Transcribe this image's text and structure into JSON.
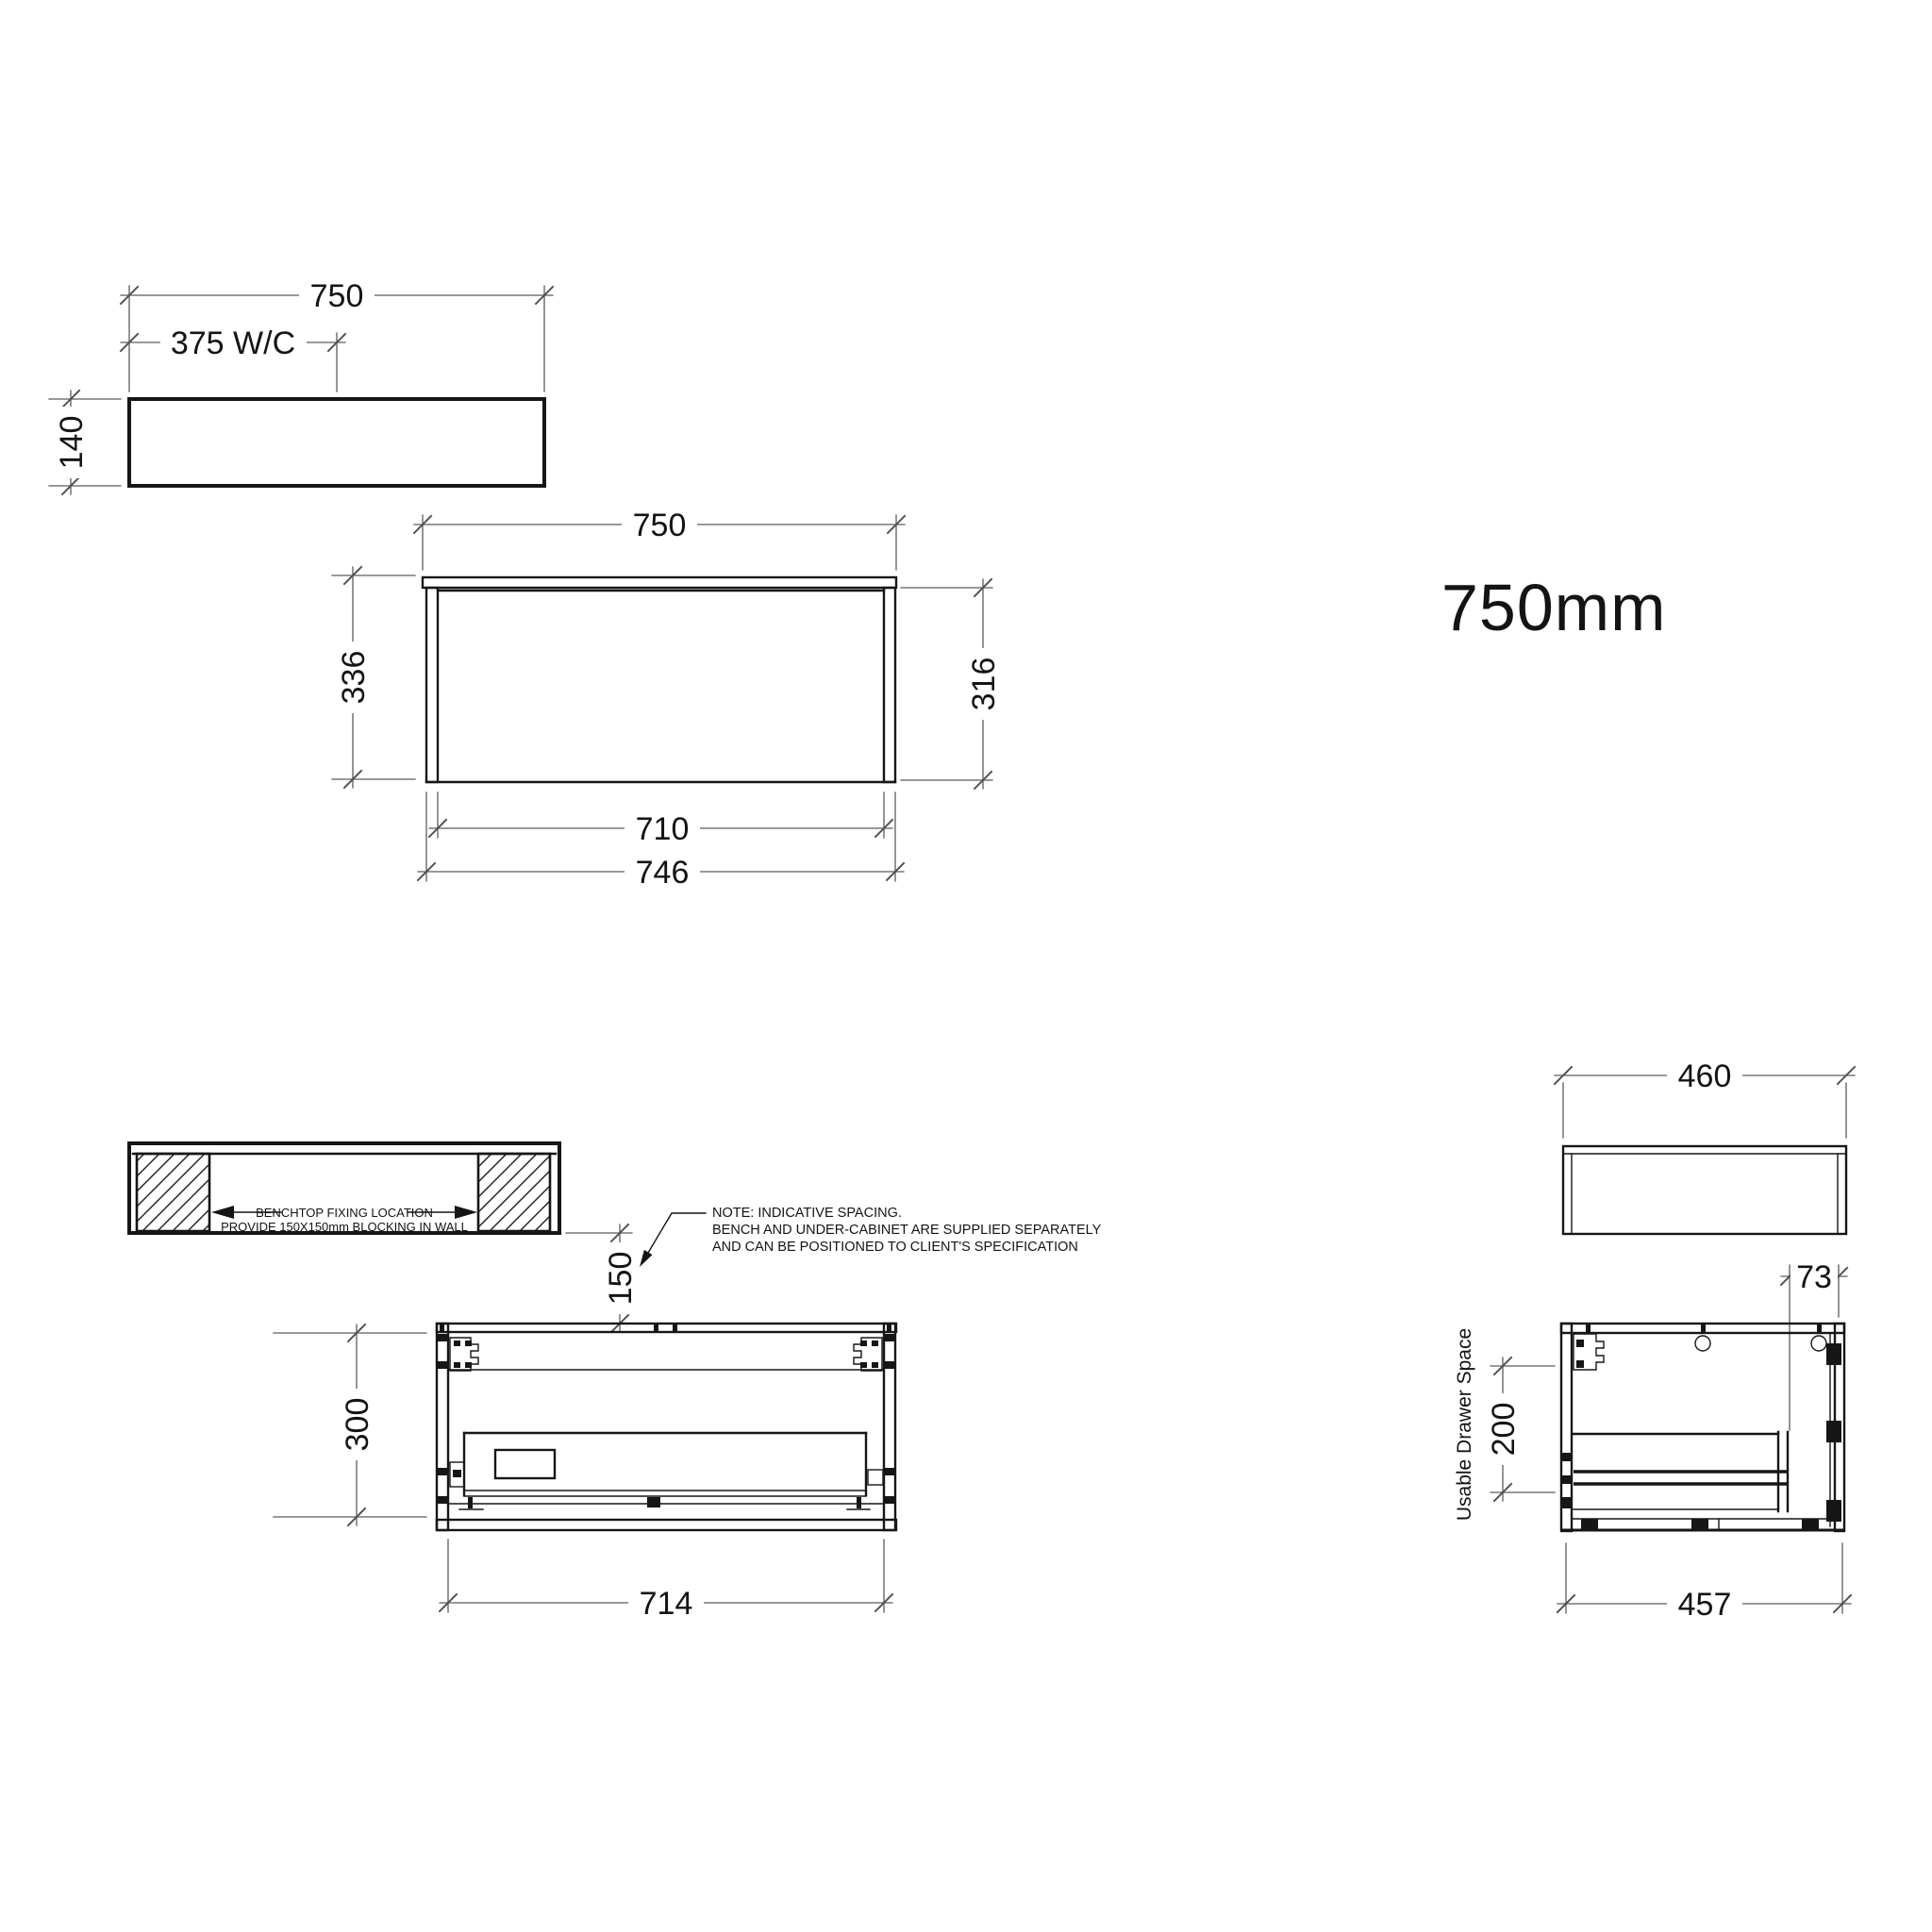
{
  "page": {
    "title": "750mm",
    "background": "#ffffff",
    "object_line_color": "#161616",
    "dimension_line_color": "#5c5c5c"
  },
  "benchtop_plan": {
    "dim_width": "750",
    "dim_waste_centre": "375 W/C",
    "dim_thickness": "140"
  },
  "front_elevation": {
    "dim_width": "750",
    "dim_height_overall": "336",
    "dim_height_cabinet": "316",
    "dim_width_inner": "710",
    "dim_width_body": "746"
  },
  "fixing_plan": {
    "label_line1": "BENCHTOP FIXING LOCATION",
    "label_line2": "PROVIDE 150X150mm BLOCKING IN WALL"
  },
  "spacing_note": {
    "dim_gap": "150",
    "note_line1": "NOTE: INDICATIVE SPACING.",
    "note_line2": "BENCH AND UNDER-CABINET ARE SUPPLIED SEPARATELY",
    "note_line3": "AND CAN BE POSITIONED TO CLIENT'S SPECIFICATION"
  },
  "cabinet_front_section": {
    "dim_height": "300",
    "dim_width": "714"
  },
  "side_plan": {
    "dim_depth": "460",
    "dim_offset": "73"
  },
  "cabinet_side_section": {
    "label_vertical": "Usable Drawer Space",
    "dim_drawer_height": "200",
    "dim_depth": "457"
  }
}
